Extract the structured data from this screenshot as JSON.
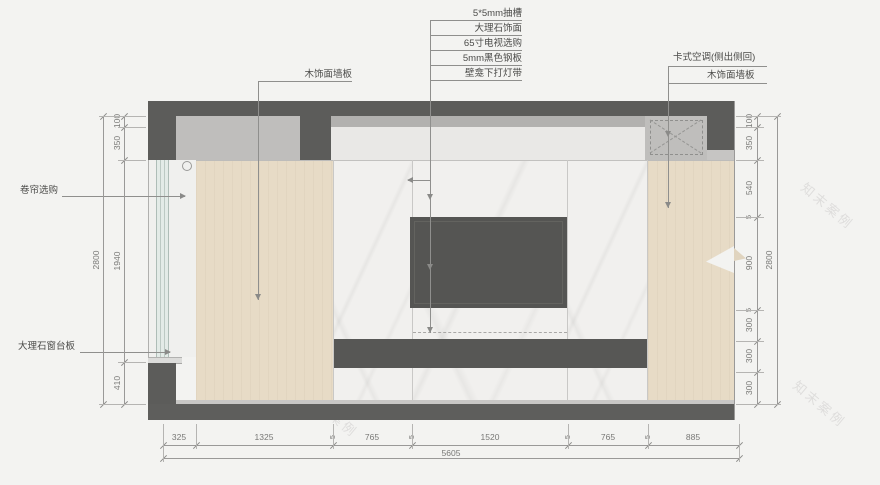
{
  "drawing": {
    "watermark": "知末案例",
    "annotations": {
      "top_stack": [
        "5*5mm抽槽",
        "大理石饰面",
        "65寸电视选购",
        "5mm黑色钢板",
        "壁龛下打灯带"
      ],
      "left_wood": "木饰面墙板",
      "roller_blind": "卷帘选购",
      "marble_sill": "大理石窗台板",
      "ac": "卡式空调(侧出侧回)",
      "right_wood": "木饰面墙板"
    },
    "dimensions": {
      "left_chain": [
        "100",
        "350",
        "1940",
        "410"
      ],
      "left_total": "2800",
      "right_chain": [
        "100",
        "350",
        "540",
        "5",
        "900",
        "5",
        "300",
        "300",
        "300"
      ],
      "right_total": "2800",
      "bottom_chain": [
        "325",
        "1325",
        "5",
        "765",
        "5",
        "1520",
        "5",
        "765",
        "5",
        "885"
      ],
      "bottom_total": "5605"
    },
    "colors": {
      "dark_band": "#5c5c5a",
      "recess_gray": "#bfbebc",
      "white_band": "#e9e8e6",
      "marble": "#f1f0ee",
      "wood": "#e7dbc6",
      "glass": "#e3ebe7",
      "page": "#f3f3f1"
    }
  }
}
